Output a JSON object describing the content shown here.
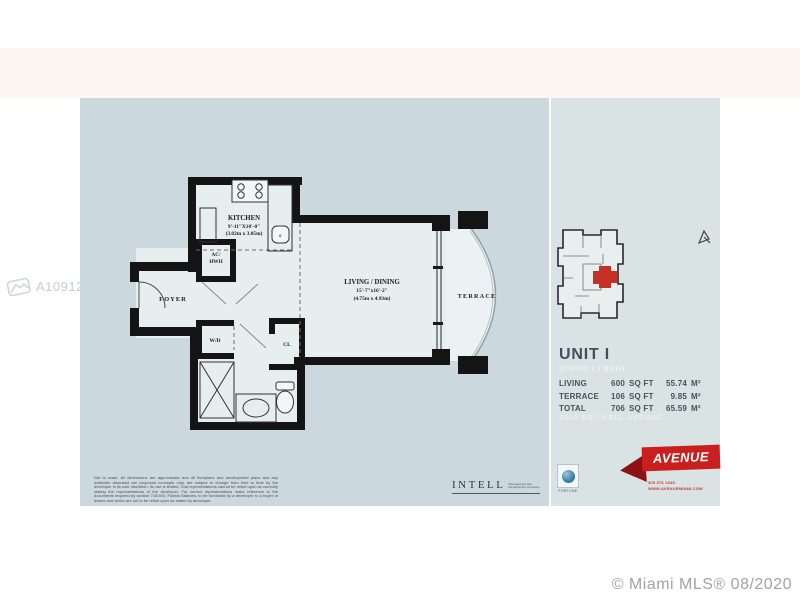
{
  "watermark": {
    "id": "A10912510"
  },
  "credit": "© Miami MLS® 08/2020",
  "plan": {
    "kitchen": {
      "name": "KITCHEN",
      "dim_ft": "9'-11\"X10'-0\"",
      "dim_m": "(3.02m x 3.05m)"
    },
    "living": {
      "name": "LIVING / DINING",
      "dim_ft": "15'-7\"x16'-2\"",
      "dim_m": "(4.75m x 4.93m)"
    },
    "terrace_label": "TERRACE",
    "foyer_label": "FOYER",
    "ac_line1": "AC/",
    "ac_line2": "HWH",
    "wd_label": "W/D",
    "cl_label": "CL",
    "sink_label": "c",
    "disclaimer": "Not to scale. All dimensions are approximate and all floorplans and development plans and any materials disclosed are proposed concepts only, are subject to change from time to time by the developer in its sole discretion. Its use is limited. Oral representations cannot be relied upon as correctly stating the representations of the developer. For correct representations make reference to the documents required by section 718.503, Florida Statutes, to be furnished by a developer to a buyer or lessee and which are not to be relied upon as stated by developer."
  },
  "info": {
    "unit_title": "UNIT I",
    "unit_subtitle": "STUDIO / 1 BATH",
    "rows": [
      {
        "label": "LIVING",
        "sqft": "600",
        "sqft_unit": "SQ FT",
        "metric": "55.74",
        "metric_unit": "M²"
      },
      {
        "label": "TERRACE",
        "sqft": "106",
        "sqft_unit": "SQ FT",
        "metric": "9.85",
        "metric_unit": "M²"
      },
      {
        "label": "TOTAL",
        "sqft": "706",
        "sqft_unit": "SQ FT",
        "metric": "65.59",
        "metric_unit": "M²"
      }
    ],
    "address": "1060 BRICKELL AVENUE"
  },
  "branding": {
    "avenue_logo": "AVENUE",
    "phone": "305 376 1945",
    "website": "WWW.AVENUEMIAMI.COM",
    "intell_logo": "INTELL",
    "intell_tag1": "Management and",
    "intell_tag2": "Development Company",
    "fortune_label": "FORTUNE"
  },
  "colors": {
    "panel_left": "#cbd9df",
    "panel_right": "#d9e3e3",
    "walls": "#141414",
    "accent_red": "#c9201f",
    "unit_red": "#c63026"
  }
}
